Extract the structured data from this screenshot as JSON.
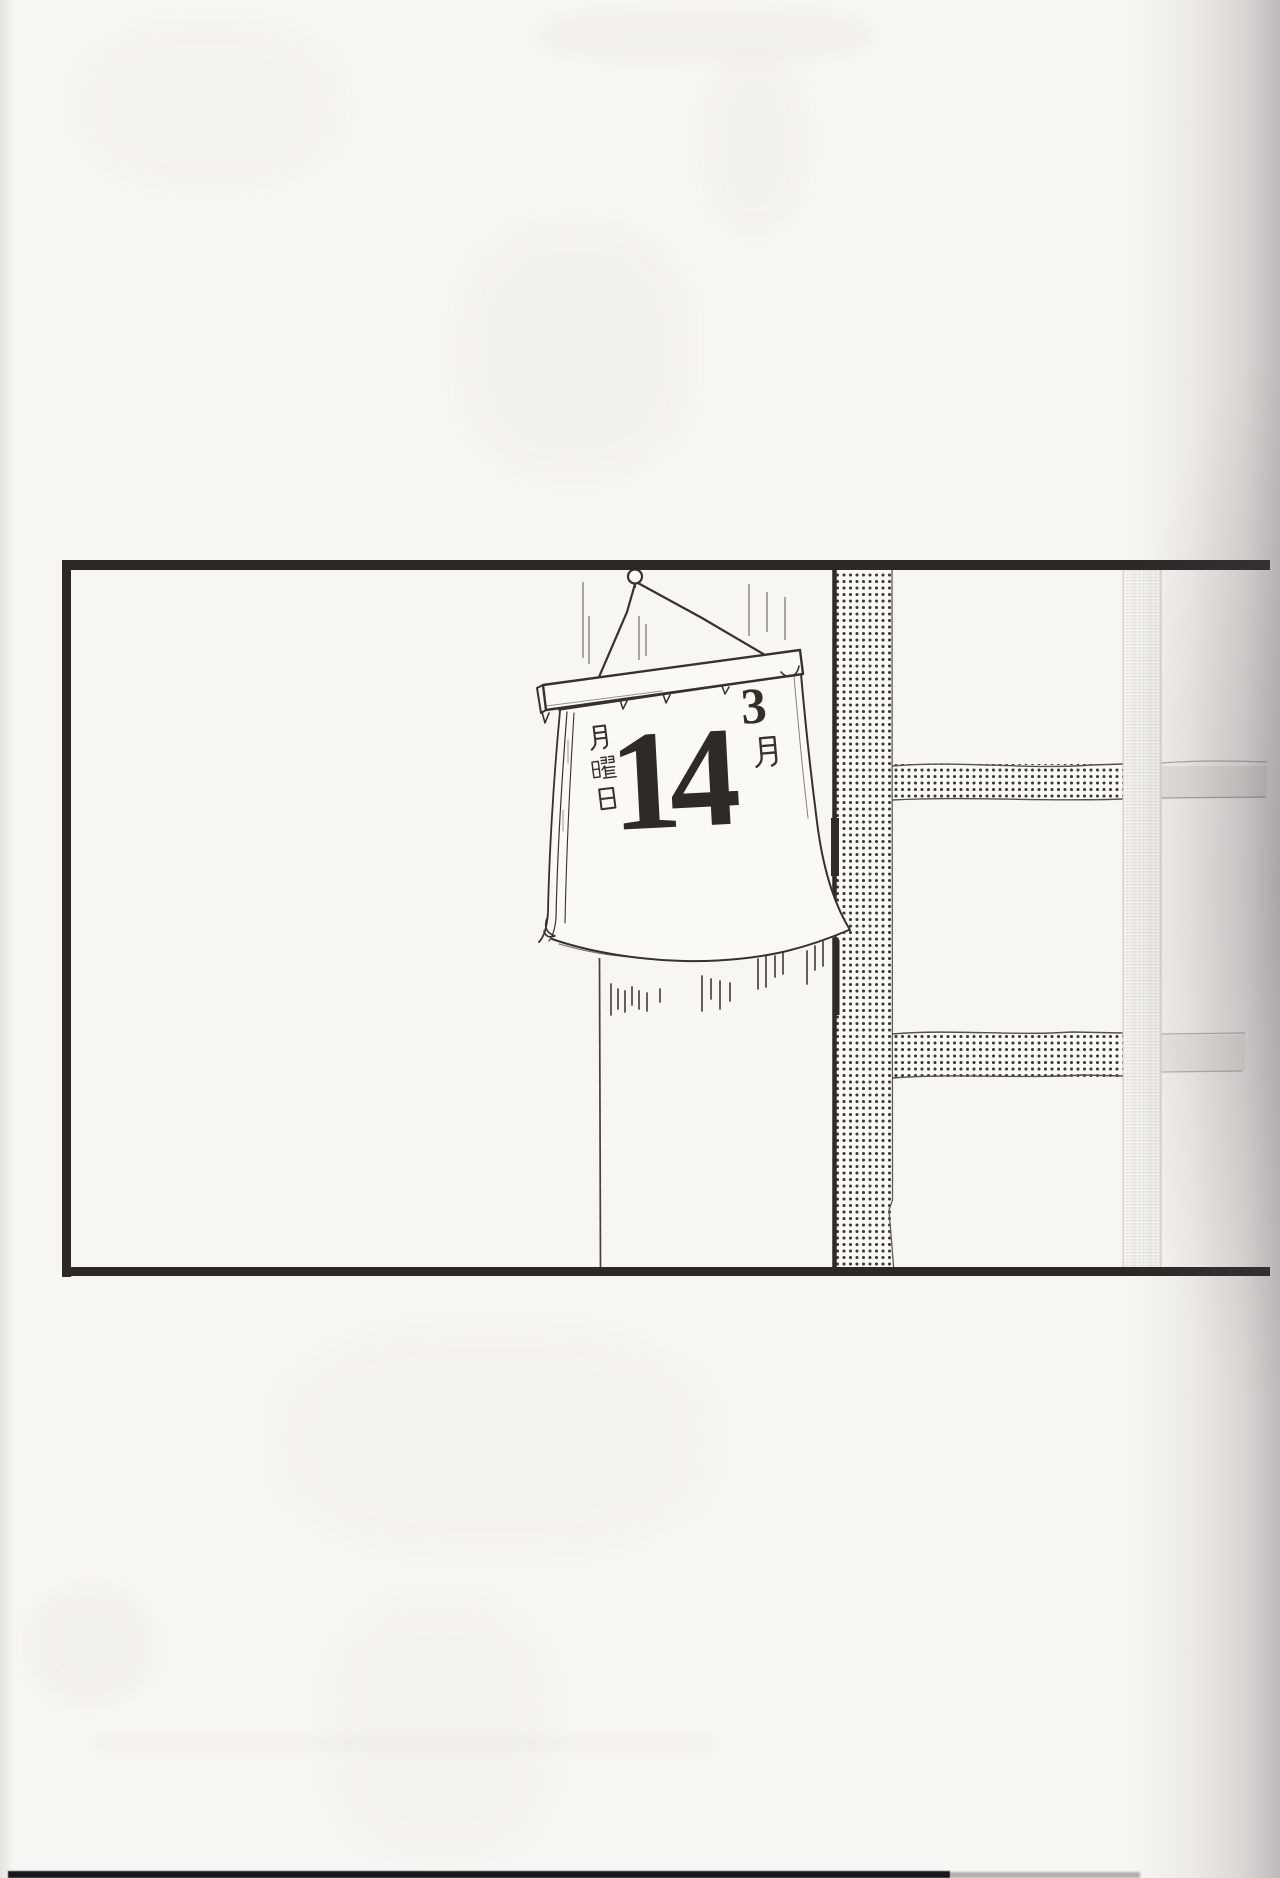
{
  "manga_page": {
    "panel": {
      "calendar": {
        "month_digit": "3",
        "month_suffix_kanji": "月",
        "month_label": "3月",
        "day_number": "14",
        "weekday_label": "月曜日",
        "weekday_chars": [
          "月",
          "曜",
          "日"
        ]
      }
    },
    "colors": {
      "paper": "#f8f6f2",
      "ink": "#36322b",
      "panel_border": "#2b2826",
      "tone_dot": "#3c3a36",
      "edge_shadow": "#6f686c"
    }
  }
}
